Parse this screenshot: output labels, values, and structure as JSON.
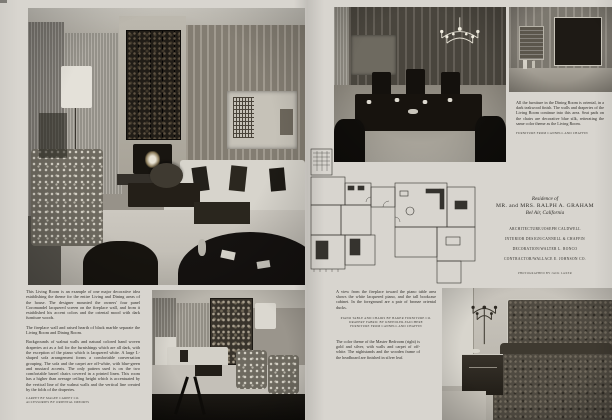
{
  "colors": {
    "paper": "#d8d5cf",
    "ink": "#2e2c28",
    "photo_dark": "#14110d"
  },
  "left": {
    "article": {
      "p1": "This Living Room is an example of one major decorative idea establishing the theme for the entire Living and Dining areas of the house. The designer mounted the owners' four panel Coromandel lacquered screen on the fireplace wall, and from it established his accent colors and the oriental mood with dark furniture woods.",
      "p2": "The fireplace wall and raised hearth of black marble separate the Living Room and Dining Room.",
      "p3": "Backgrounds of walnut walls and natural colored hand woven draperies act as a foil for the furnishings which are all dark, with the exception of the piano which is lacquered white. A large L-shaped sofa arrangement forms a comfortable conversation grouping. The sofa and the carpet are off-white, with blue-green and mustard accents. The only pattern used is on the two comfortable barrel chairs covered in a printed linen. This room has a higher than average ceiling height which is accentuated by the vertical line of the walnut walls and the vertical line created by the folds of the draperies.",
      "credits": [
        "Carpet by Magee Carpet Co.",
        "Accessories by Oriental Imports"
      ]
    }
  },
  "right": {
    "dining_caption": {
      "body": "All the furniture in the Dining Room is oriental, in a dark teakwood finish. The walls and draperies of the Living Room continue into this area. Seat pads on the chairs are decorative blue silk, reiterating the same color theme as the Living Room.",
      "credit": "Furniture from Cannell and Chaffin"
    },
    "residence": {
      "eyebrow": "Residence of",
      "name": "MR. and MRS. RALPH A. GRAHAM",
      "location": "Bel Air, California",
      "credits": [
        "ARCHITECTURE/JOSEPH CALDWELL",
        "INTERIOR DESIGN/CANNELL & CHAFFIN",
        "DECORATION/WALTER L. RONCO",
        "CONTRACTOR/WALLACE E. JOHNSON CO."
      ],
      "photographer": "PHOTOGRAPHED BY JACK LAXER"
    },
    "view_caption": {
      "body": "A view from the fireplace toward the piano table area shows the white lacquered piano, and the tall bookcase cabinet. In the foreground are a pair of bronze oriental ducks.",
      "credits": [
        "Piano table and chairs by Baker Furniture Co.",
        "Drapery fabric by Kneedler-Fauchere",
        "Furniture from Cannell and Chaffin"
      ]
    },
    "bedroom_caption": {
      "body": "The color theme of the Master Bedroom (right) is gold and silver, with walls and carpet of off-white. The nightstands and the wooden frame of the headboard are finished in silver leaf."
    }
  }
}
